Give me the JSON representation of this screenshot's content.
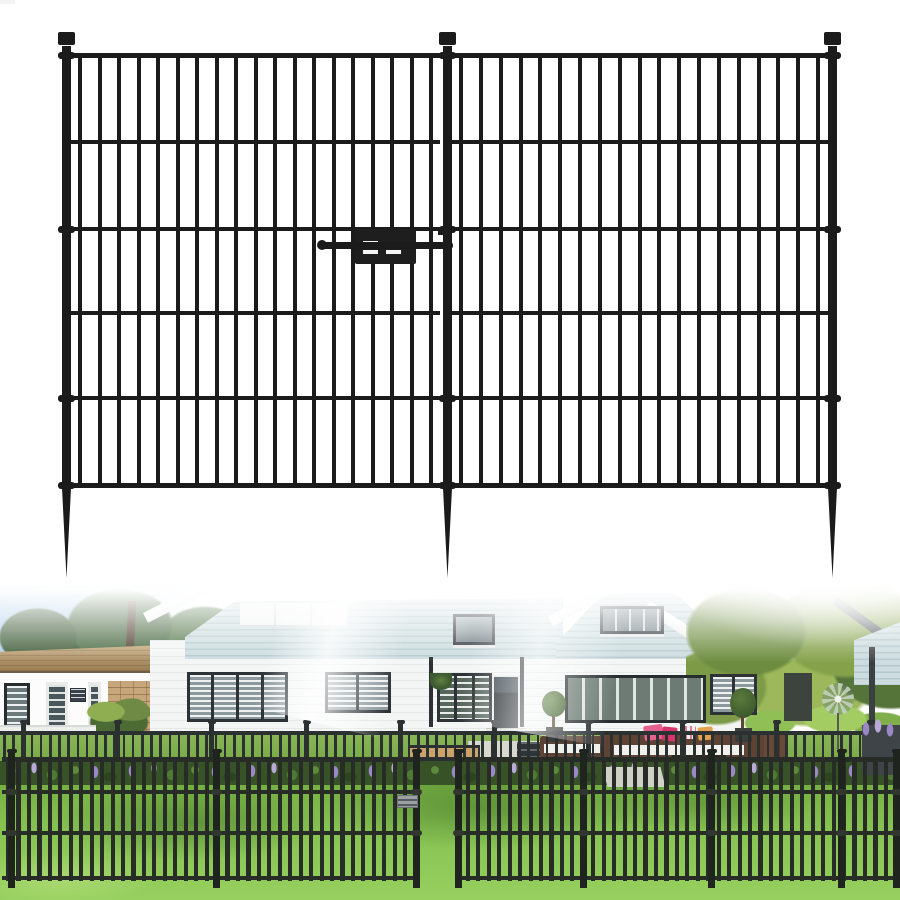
{
  "scene": {
    "description": "Product listing image of a black metal no-dig garden fence gate: technical product render on white above, lifestyle photo of the fence installed in a front yard below",
    "visible_text": []
  },
  "colors": {
    "gate_metal": "#1b1b1b",
    "fence_dark": "#272c26",
    "bg_fence": "#2b3031",
    "sky": "#a9cbe9",
    "siding": "#ccdcdf",
    "siding_stripe": "#b4c8cc",
    "wall_white": "#f4f6f5",
    "window_frame": "#2d3236",
    "roof_tan": "#ab8e66",
    "brick": "#c7a67c",
    "grass": "#74ad41",
    "lavender": "#9c87c6",
    "cushion_pink": "#e7618f",
    "cushion_magenta": "#d8356f",
    "furniture_brown": "#5e4234",
    "path": "#d8d8d0"
  },
  "gate": {
    "description": "Two-panel gate, three spiked posts with square caps, slide-bolt latch",
    "posts_x": [
      62,
      443,
      828
    ],
    "post_width": 9,
    "post_top": 46,
    "post_bottom": 488,
    "spike_length": 90,
    "cap": {
      "y": 32,
      "height": 13,
      "overhang": 4
    },
    "rails_y": [
      53,
      140,
      227,
      311,
      396,
      483
    ],
    "clamp_rails_y": [
      53,
      227,
      396,
      483
    ],
    "bar_width": 4,
    "bar_top": 53,
    "bar_bottom": 488,
    "panels": [
      {
        "rail_x1": 71,
        "rail_x2": 440,
        "bar_x1": 78,
        "bar_x2": 429,
        "bars": 19
      },
      {
        "rail_x1": 452,
        "rail_x2": 829,
        "bar_x1": 459,
        "bar_x2": 816,
        "bars": 19
      }
    ]
  },
  "photo": {
    "background_fence": {
      "rail_y": 146,
      "bar_top": 146,
      "bar_bottom": 197,
      "bar_width": 2.6,
      "spacing": 9.2,
      "bar_start": 3,
      "posts_x": [
        21,
        115,
        209,
        304,
        398,
        492,
        586,
        680,
        774,
        868
      ],
      "post_width": 5,
      "post_top": 139,
      "post_bottom": 197
    },
    "foreground_fence": {
      "rails_y": [
        172,
        205,
        246,
        291
      ],
      "rail_segments": [
        [
          2,
          417
        ],
        [
          456,
          898
        ]
      ],
      "bar_top": 172,
      "bar_bottom": 296,
      "bar_width": 4.2,
      "spacing": 10.45,
      "bar_start": 6,
      "gap": [
        407,
        463
      ],
      "posts_x": [
        8,
        213,
        413,
        455,
        580,
        708,
        838,
        893
      ],
      "post_width": 7,
      "post_top": 167,
      "post_bottom": 303,
      "clamp_rail_indexes": [
        1,
        2
      ],
      "latch_plate": {
        "x": 397,
        "y": 210,
        "w": 21,
        "h": 13
      }
    }
  }
}
